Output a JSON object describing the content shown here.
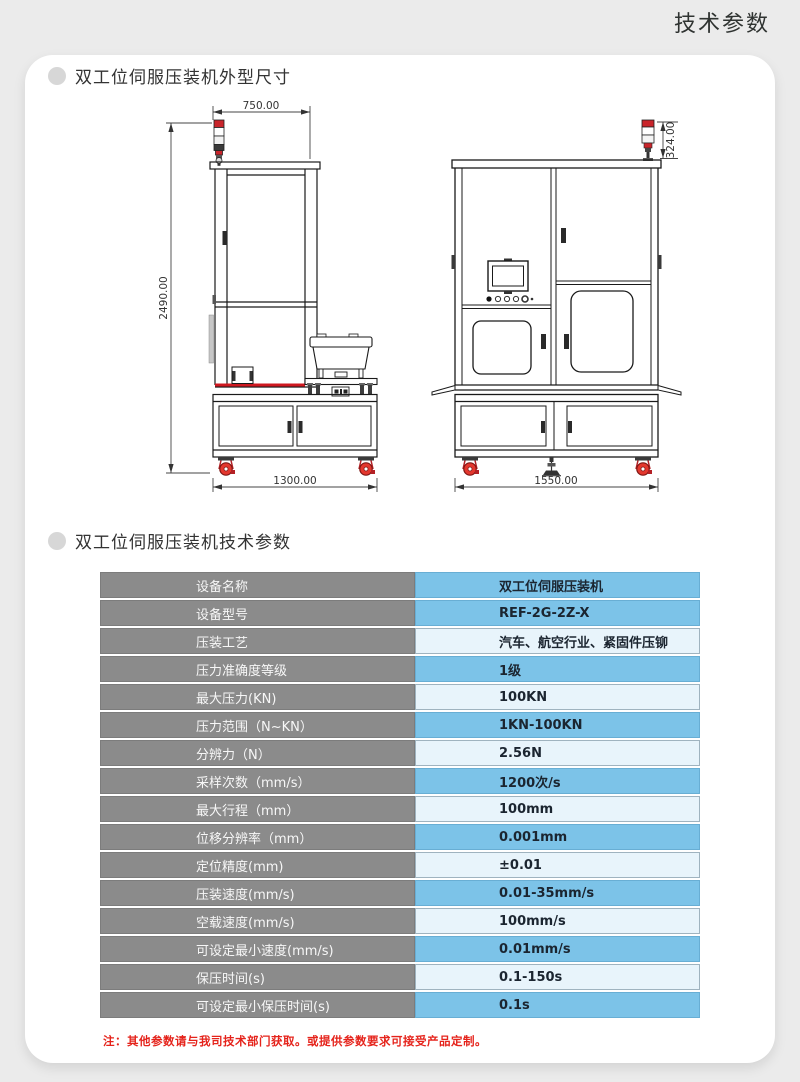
{
  "page": {
    "title": "技术参数"
  },
  "sections": [
    {
      "title": "双工位伺服压装机外型尺寸"
    },
    {
      "title": "双工位伺服压装机技术参数"
    }
  ],
  "drawings": {
    "left_view": {
      "width_top": "750.00",
      "height": "2490.00",
      "width_bottom": "1300.00"
    },
    "front_view": {
      "lamp_height": "324.00",
      "width_bottom": "1550.00"
    }
  },
  "table": {
    "rows": [
      {
        "label": "设备名称",
        "value": "双工位伺服压装机"
      },
      {
        "label": "设备型号",
        "value": "REF-2G-2Z-X"
      },
      {
        "label": "压装工艺",
        "value": "汽车、航空行业、紧固件压铆"
      },
      {
        "label": "压力准确度等级",
        "value": "1级"
      },
      {
        "label": "最大压力(KN)",
        "value": "100KN"
      },
      {
        "label": "压力范围（N~KN）",
        "value": "1KN-100KN"
      },
      {
        "label": "分辨力（N）",
        "value": "2.56N"
      },
      {
        "label": "采样次数（mm/s）",
        "value": "1200次/s"
      },
      {
        "label": "最大行程（mm）",
        "value": "100mm"
      },
      {
        "label": "位移分辨率（mm）",
        "value": "0.001mm"
      },
      {
        "label": "定位精度(mm)",
        "value": "±0.01"
      },
      {
        "label": "压装速度(mm/s)",
        "value": "0.01-35mm/s"
      },
      {
        "label": "空载速度(mm/s)",
        "value": "100mm/s"
      },
      {
        "label": "可设定最小速度(mm/s)",
        "value": "0.01mm/s"
      },
      {
        "label": "保压时间(s)",
        "value": "0.1-150s"
      },
      {
        "label": "可设定最小保压时间(s)",
        "value": "0.1s"
      }
    ]
  },
  "note": "注：其他参数请与我司技术部门获取。或提供参数要求可接受产品定制。",
  "colors": {
    "value_blue": "#7cc3e8",
    "value_light": "#e8f4fb",
    "label_gray": "#8b8b8b",
    "note_red": "#e5231b",
    "drawing_red": "#c9252b"
  }
}
